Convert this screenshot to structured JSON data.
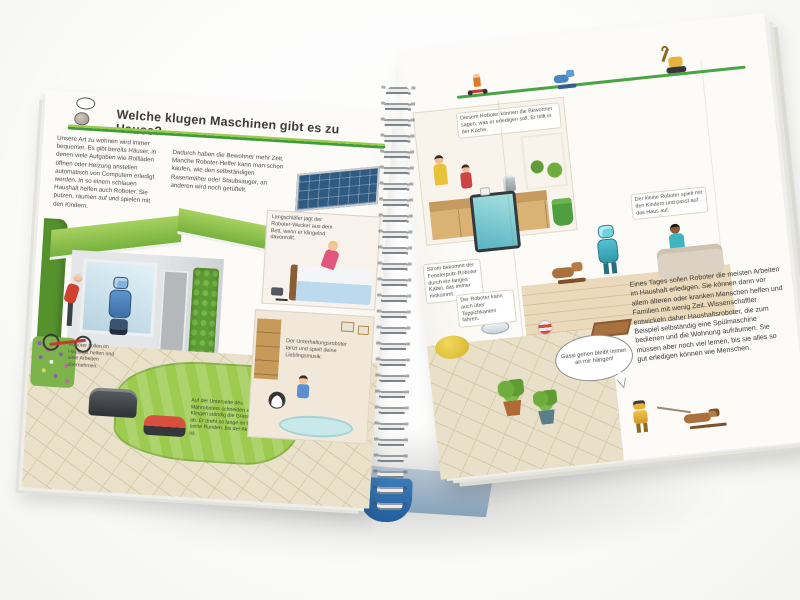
{
  "photo": {
    "subject": "Aufgeschlagenes Kinder-Sachbuch mit Spiralbindung",
    "accent_green": "#3f9b3b",
    "cover_blue": "#2d6fad"
  },
  "left_page": {
    "title": "Welche klugen Maschinen gibt es zu Hause?",
    "intro_col1": "Unsere Art zu wohnen wird immer bequemer. Es gibt bereits Häuser, in denen viele Aufgaben wie Rollläden öffnen oder Heizung anstellen automatisch von Computern erledigt werden. In so einem schlauen Haushalt helfen auch Roboter. Sie putzen, räumen auf und spielen mit den Kindern.",
    "intro_col2": "Dadurch haben die Bewohner mehr Zeit. Manche Roboter-Helfer kann man schon kaufen, wie den selbständigen Rasenmäher oder Staubsauger, an anderen wird noch getüftelt.",
    "caption_household_robot": "Roboter sollen im Haushalt helfen und viele Arbeiten übernehmen.",
    "caption_mower": "Auf der Unterseite des Mähroboters schneiden scharfe Klingen ständig die Grasspitzen ab. Er dreht so lange im Garten seine Runden, bis der Akku leer ist.",
    "caption_wecker": "Langschläfer jagt der Roboter-Wecker aus dem Bett, wenn er klingelnd davonrollt.",
    "caption_entertainment": "Der Unterhaltungsroboter tanzt und spielt deine Lieblingsmusik."
  },
  "right_page": {
    "caption_kitchen": "Diesem Roboter können die Bewohner sagen, was er erledigen soll. Er hilft in der Küche.",
    "caption_window_robot": "Strom bekommt der Fensterputz-Roboter durch ein langes Kabel, das immer mitkommt.",
    "caption_companion": "Der kleine Roboter spielt mit den Kindern und passt auf das Haus auf.",
    "caption_vacuum": "Der Roboter kann auch über Teppichkanten fahren.",
    "body_text": "Eines Tages sollen Roboter die meisten Arbeiten im Haushalt erledigen. Sie können dann vor allem älteren oder kranken Menschen helfen und Familien mit wenig Zeit. Wissenschaftler entwickeln daher Haushaltsroboter, die zum Beispiel selbständig eine Spülmaschine bedienen und die Wohnung aufräumen. Sie müssen aber noch viel lernen, bis sie alles so gut erledigen können wie Menschen.",
    "speech_bubble": "Gassi gehen bleibt immer an mir hängen!"
  }
}
